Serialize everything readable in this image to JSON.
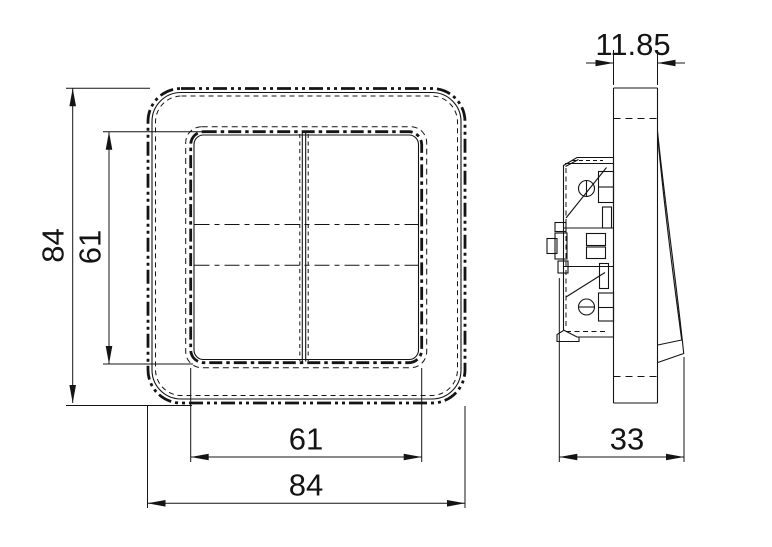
{
  "drawing": {
    "type": "technical-dimension-drawing",
    "subject": "two-gang rocker wall switch",
    "colors": {
      "line": "#141414",
      "background": "#ffffff"
    },
    "front_view": {
      "outer_height_label": "84",
      "inner_height_label": "61",
      "inner_width_label": "61",
      "outer_width_label": "84"
    },
    "side_view": {
      "thickness_label": "11.85",
      "depth_label": "33"
    }
  }
}
